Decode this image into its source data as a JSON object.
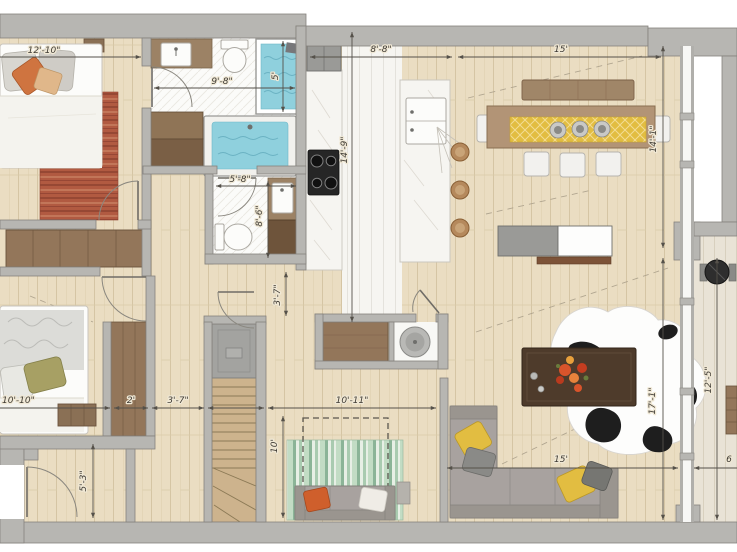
{
  "plan": {
    "dimensions": {
      "master_bedroom_width": "12'-10\"",
      "master_bath_width": "9'-8\"",
      "shower_width": "5'",
      "kitchen_width": "8'-8\"",
      "kitchen_length": "14'-9\"",
      "dining_width": "15'",
      "dining_depth": "14'-1\"",
      "bath2_width": "5'-8\"",
      "bath2_depth": "8'-6\"",
      "hall_clearance": "3'-7\"",
      "closet_width": "2'",
      "closet_offset": "3'-7\"",
      "bedroom2_width": "10'-10\"",
      "entry_depth": "5'-3\"",
      "den_width": "10'-11\"",
      "den_depth": "10'",
      "living_width": "15'",
      "living_depth": "17'-1\"",
      "balcony_depth": "12'-5\"",
      "balcony_width_partial": "6"
    },
    "palette": {
      "wall_gray": "#b7b6b2",
      "floor_wood": "#eaddc2",
      "water_blue": "#8fd0dd",
      "accent_yellow": "#e2bd41",
      "accent_orange": "#cf5f2c",
      "rug_red": "#b15a41",
      "sofa_gray": "#a8a29f",
      "dim_line": "#55514a"
    }
  }
}
